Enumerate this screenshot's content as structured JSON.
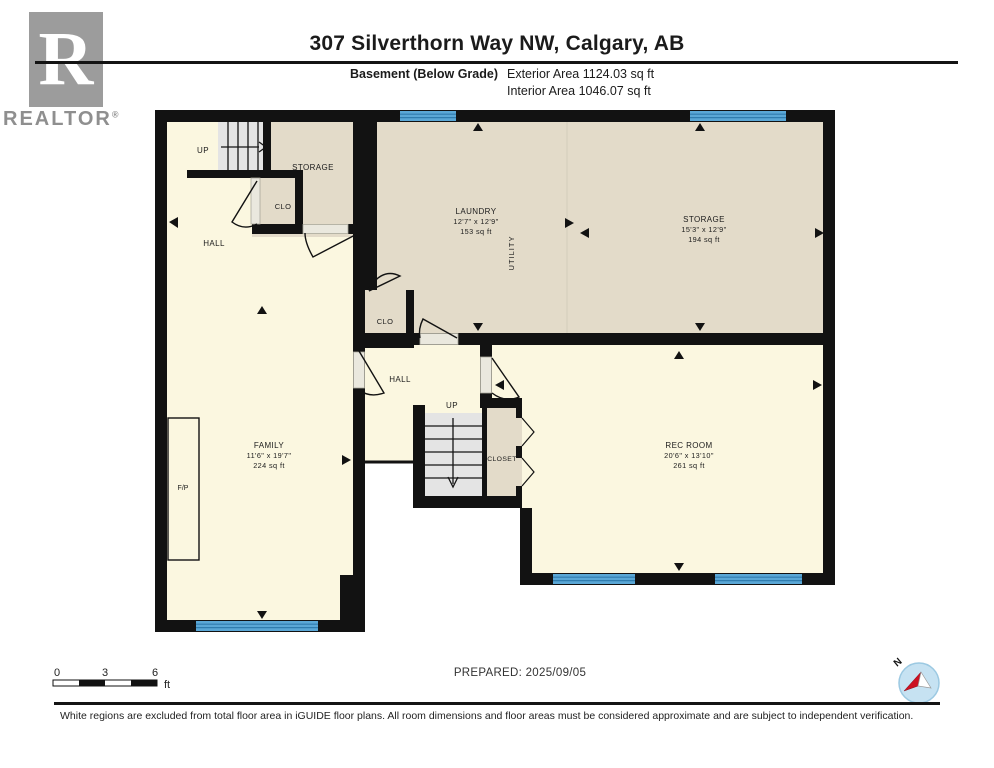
{
  "header": {
    "logo_letter": "R",
    "brand": "REALTOR",
    "registered": "®",
    "title": "307 Silverthorn Way NW, Calgary, AB",
    "floor_label": "Basement (Below Grade)",
    "exterior_area": "Exterior Area 1124.03 sq ft",
    "interior_area": "Interior Area 1046.07 sq ft"
  },
  "plan": {
    "rooms": {
      "up_top": {
        "label": "UP"
      },
      "storage_top": {
        "label": "STORAGE"
      },
      "clo_top": {
        "label": "CLO"
      },
      "hall_top": {
        "label": "HALL"
      },
      "laundry": {
        "label": "LAUNDRY",
        "dimensions": "12'7\" x 12'9\"",
        "area": "153 sq ft"
      },
      "utility": {
        "label": "UTILITY"
      },
      "storage": {
        "label": "STORAGE",
        "dimensions": "15'3\" x 12'9\"",
        "area": "194 sq ft"
      },
      "clo_mid": {
        "label": "CLO"
      },
      "hall_mid": {
        "label": "HALL"
      },
      "up_mid": {
        "label": "UP"
      },
      "closet": {
        "label": "CLOSET"
      },
      "family": {
        "label": "FAMILY",
        "dimensions": "11'6\" x 19'7\"",
        "area": "224 sq ft"
      },
      "rec_room": {
        "label": "REC ROOM",
        "dimensions": "20'6\" x 13'10\"",
        "area": "261 sq ft"
      },
      "fireplace": {
        "label": "F/P"
      }
    }
  },
  "footer": {
    "scale": {
      "t0": "0",
      "t3": "3",
      "t6": "6",
      "unit": "ft"
    },
    "prepared": "PREPARED: 2025/09/05",
    "compass_label": "N",
    "disclaimer": "White regions are excluded from total floor area in iGUIDE floor plans. All room dimensions and floor areas must be considered approximate and are subject to independent verification."
  },
  "colors": {
    "floor_cream": "#FBF7E0",
    "floor_beige": "#E3DBC9",
    "wall": "#121212",
    "window_blue": "#5AA7D6",
    "stair_gray": "#E4E4E4"
  }
}
